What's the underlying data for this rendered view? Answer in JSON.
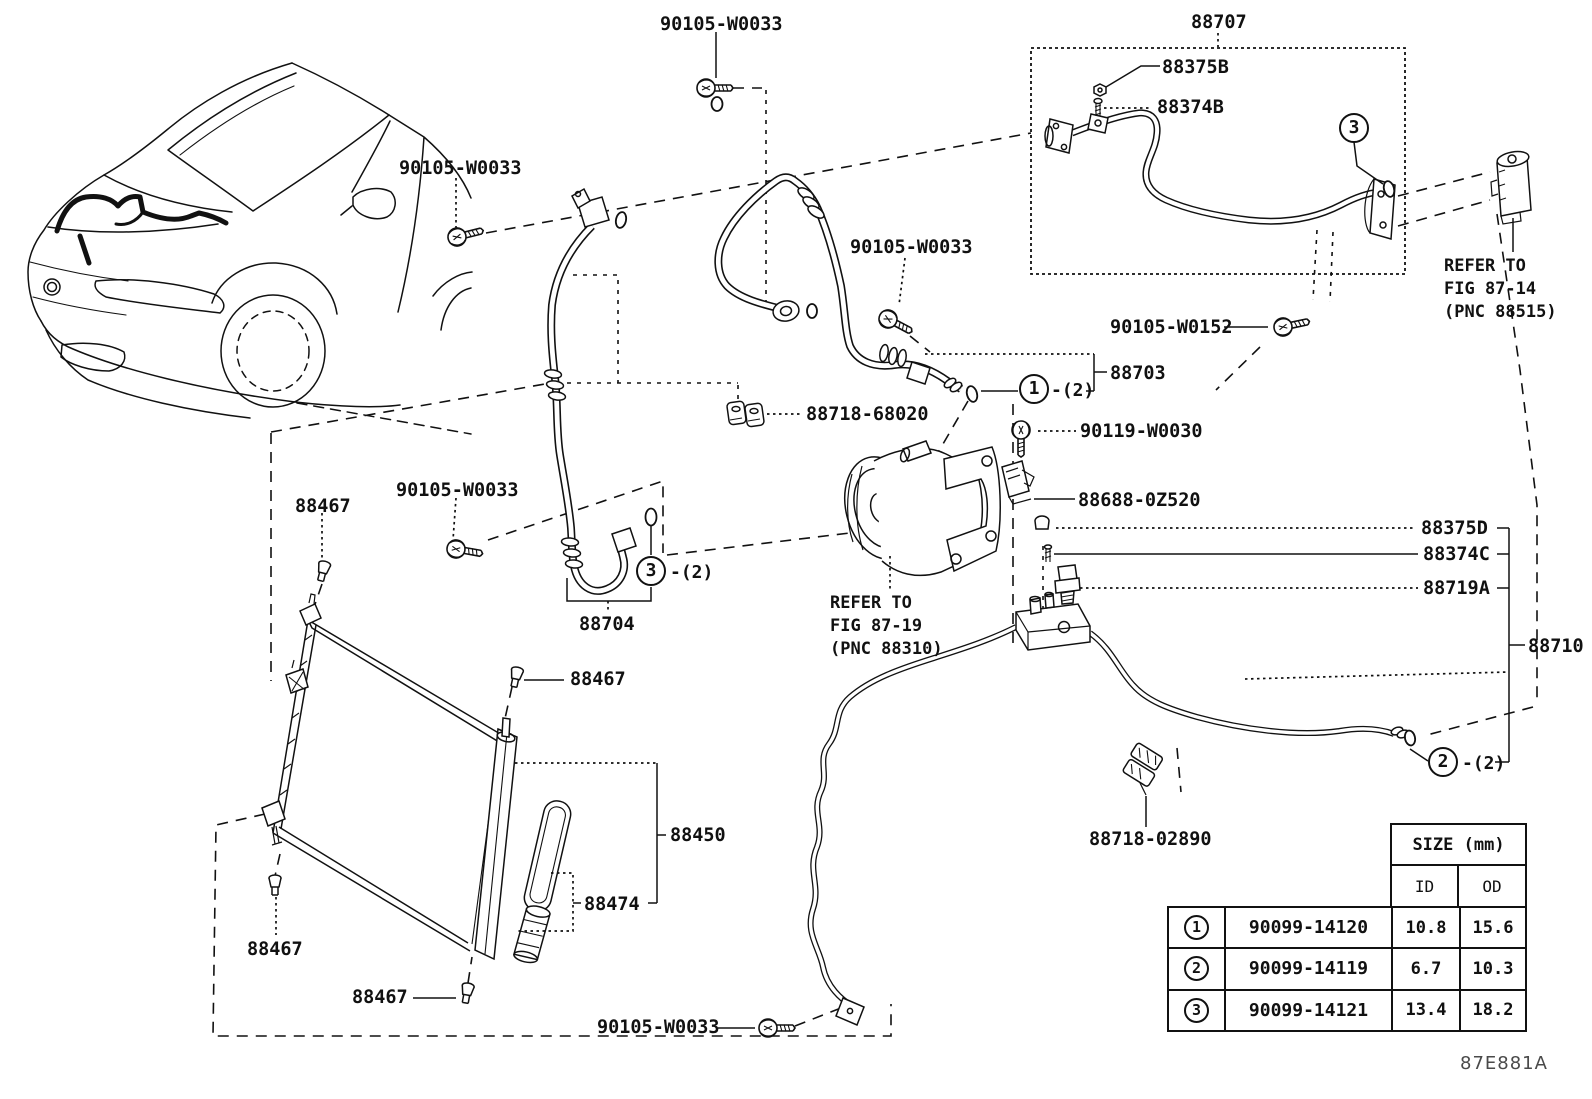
{
  "drawing_code": "87E881A",
  "labels": [
    {
      "text": "90105-W0033"
    },
    {
      "text": "88707"
    },
    {
      "text": "88375B"
    },
    {
      "text": "88374B"
    },
    {
      "text": "90105-W0033"
    },
    {
      "text": "90105-W0033"
    },
    {
      "text": "90105-W0152"
    },
    {
      "text": "88703"
    },
    {
      "text": "88718-68020"
    },
    {
      "text": "90119-W0030"
    },
    {
      "text": "88688-0Z520"
    },
    {
      "text": "88375D"
    },
    {
      "text": "88374C"
    },
    {
      "text": "88719A"
    },
    {
      "text": "88710"
    },
    {
      "text": "90105-W0033"
    },
    {
      "text": "88467"
    },
    {
      "text": "88704"
    },
    {
      "text": "88467"
    },
    {
      "text": "88450"
    },
    {
      "text": "88474"
    },
    {
      "text": "88467"
    },
    {
      "text": "88467"
    },
    {
      "text": "90105-W0033"
    },
    {
      "text": "88718-02890"
    }
  ],
  "callouts": {
    "c1": {
      "num": "1",
      "suffix": "-(2)"
    },
    "c2": {
      "num": "2",
      "suffix": "-(2)"
    },
    "c3_box": {
      "num": "3",
      "suffix": ""
    },
    "c3_mid": {
      "num": "3",
      "suffix": "-(2)"
    }
  },
  "refer_notes": {
    "fig_87_14": {
      "line1": "REFER TO",
      "line2": "FIG 87-14",
      "line3": "(PNC 88515)"
    },
    "fig_87_19": {
      "line1": "REFER TO",
      "line2": "FIG 87-19",
      "line3": "(PNC 88310)"
    }
  },
  "size_table": {
    "title": "SIZE (mm)",
    "id_header": "ID",
    "od_header": "OD",
    "rows": [
      {
        "callout": "1",
        "part_no": "90099-14120",
        "id": "10.8",
        "od": "15.6"
      },
      {
        "callout": "2",
        "part_no": "90099-14119",
        "id": "6.7",
        "od": "10.3"
      },
      {
        "callout": "3",
        "part_no": "90099-14121",
        "id": "13.4",
        "od": "18.2"
      }
    ]
  }
}
